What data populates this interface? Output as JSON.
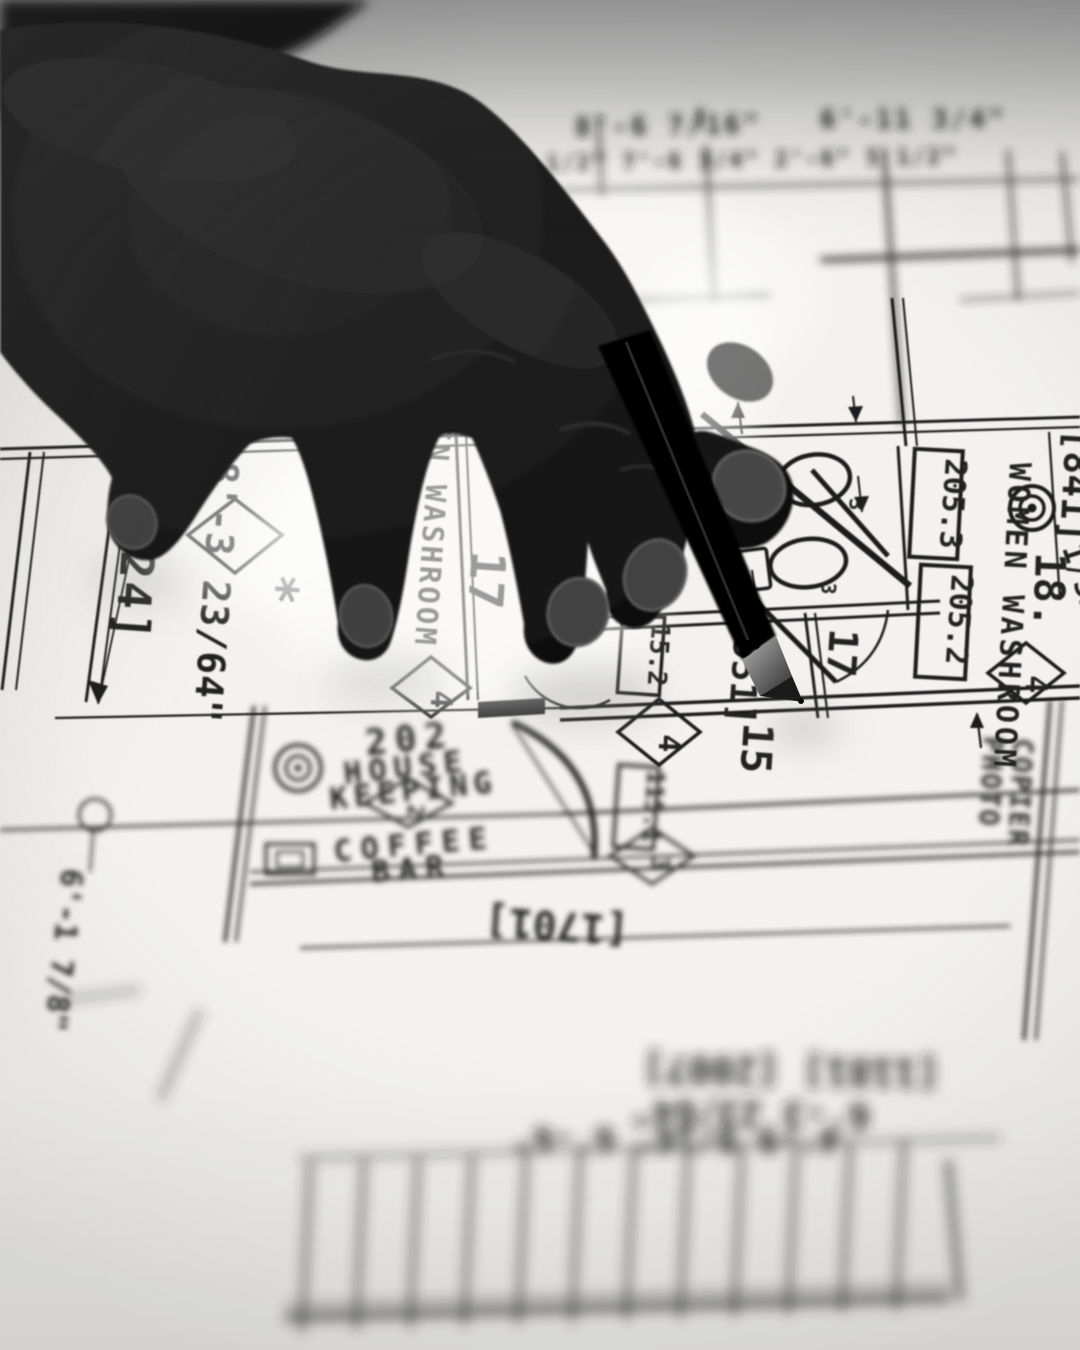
{
  "photo": {
    "tones": {
      "paper": "#f3f2ef",
      "ink": "#1e1e1e",
      "far_gray": "#a6a6a6",
      "hand": "#141414",
      "nail": "#4a4a4a",
      "metal": "#8f8f8f",
      "glow": "#ffffff"
    }
  },
  "blueprint": {
    "rooms": {
      "housekeeping": {
        "number": "202",
        "name_line1": "HOUSE",
        "name_line2": "KEEPING"
      },
      "coffee_bar": {
        "line1": "COFFEE",
        "line2": "BAR"
      },
      "washroom_left": {
        "name": "MEN WASHROOM",
        "number": "17"
      },
      "washroom_right": {
        "name": "WOMEN WASHROOM",
        "number": "18."
      },
      "photo_copier": {
        "line1": "PHOTO",
        "line2": "COPIER"
      }
    },
    "dimensions": {
      "d2524": "[2524]",
      "d8_3": "8'-3 23/64\"",
      "star": "*",
      "d841": "[841]",
      "d1_32": "1/32\"",
      "d1701": "[1701]",
      "d951": "[951]",
      "n15": "15",
      "n17": "17",
      "n3": "3"
    },
    "door_tags": {
      "t205_3": "205.3",
      "t205_2": "205.2",
      "t15_2": "15.2",
      "t115_1": "115.1"
    },
    "keynotes": {
      "k1": "4",
      "k2": "4",
      "k3": "4",
      "k4": "2",
      "k5": "3"
    },
    "blurred_texts": {
      "top_1": "8'-6 7/16\"",
      "top_2": "6'-11 3/4\"",
      "top_3": "4'-0 1/2\"   7'-6 3/4\"   2'-6\"   5 1/2\"",
      "bottom_1": "[1181]  [2007]",
      "bottom_2": "6'-3 23/64\"",
      "bottom_3": "4'-9 9/16\"  6'-6\"",
      "left_1": "[101",
      "left_2": "1 4",
      "left_3": "6'-1 7/8\""
    }
  }
}
